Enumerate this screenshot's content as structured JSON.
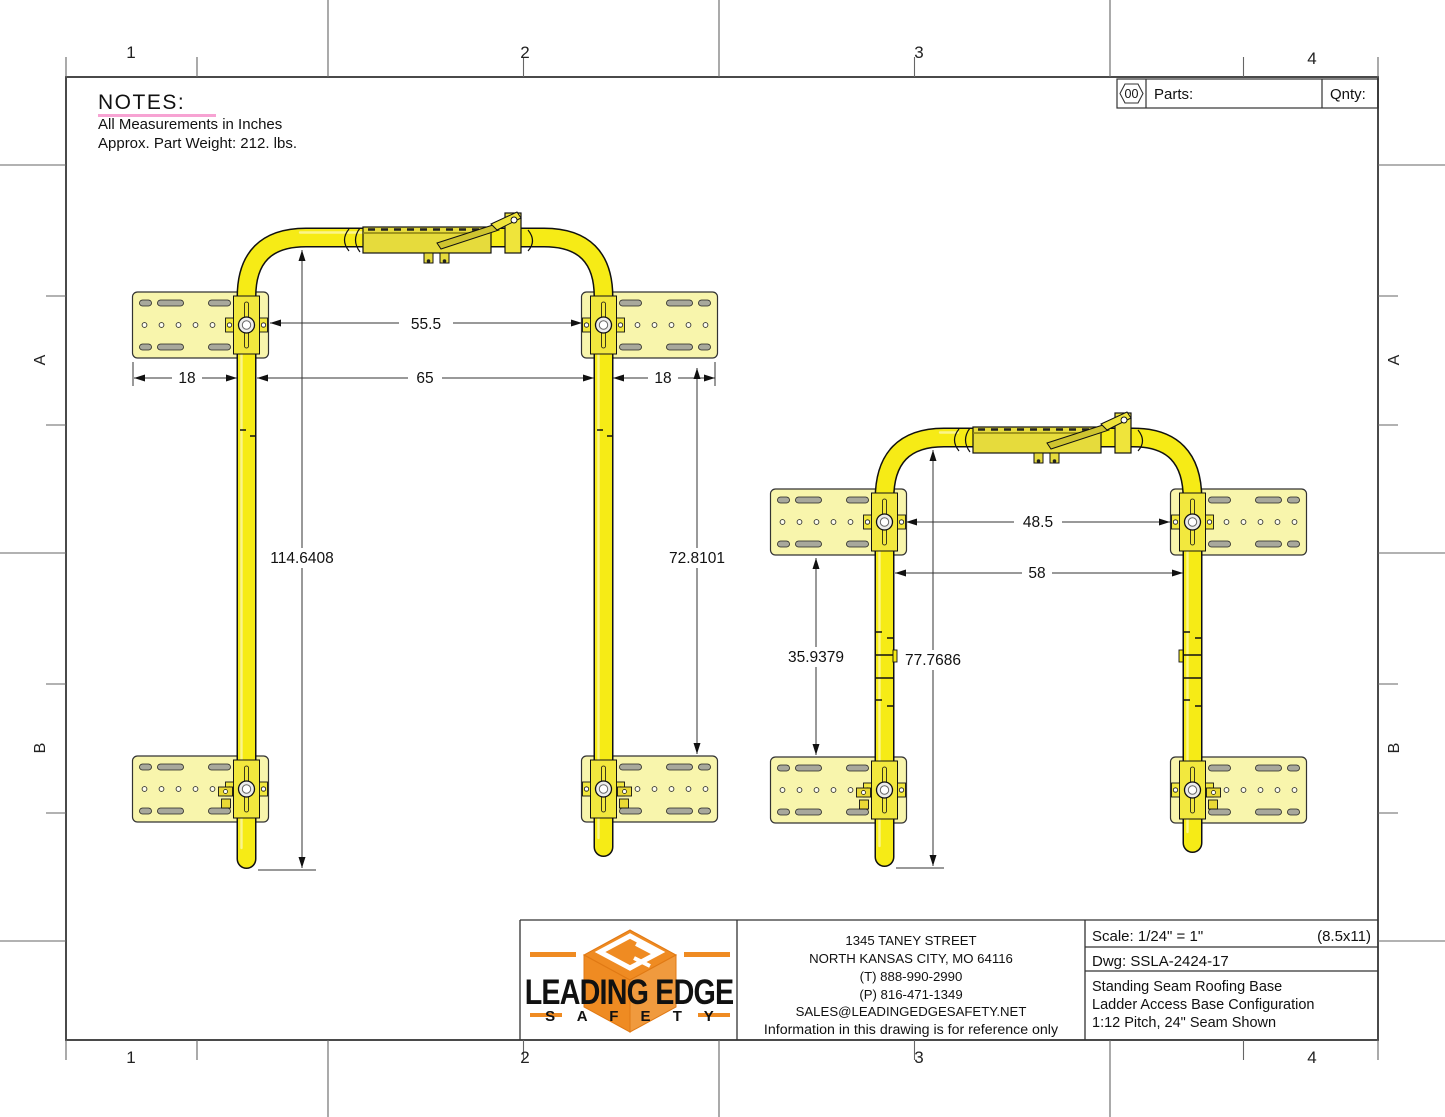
{
  "sheet": {
    "zone_columns": [
      "1",
      "2",
      "3",
      "4"
    ],
    "zone_rows": [
      "A",
      "B"
    ]
  },
  "notes": {
    "title": "NOTES:",
    "lines": [
      "All Measurements in Inches",
      "Approx. Part Weight: 212. lbs."
    ]
  },
  "parts_header": {
    "badge": "00",
    "parts_label": "Parts:",
    "qnty_label": "Qnty:"
  },
  "left_view": {
    "dim_width_between_plates": "55.5",
    "dim_left_plate_width": "18",
    "dim_inner_width": "65",
    "dim_right_plate_width": "18",
    "dim_total_height": "114.6408",
    "dim_right_height": "72.8101"
  },
  "right_view": {
    "dim_width_between_plates": "48.5",
    "dim_inner_width": "58",
    "dim_left_height": "35.9379",
    "dim_total_height": "77.7686"
  },
  "title_block": {
    "logo": {
      "line1": "LEADING EDGE",
      "line2": "S A F E T Y"
    },
    "address": [
      "1345 TANEY STREET",
      "NORTH KANSAS CITY, MO 64116",
      "(T) 888-990-2990",
      "(P) 816-471-1349",
      "SALES@LEADINGEDGESAFETY.NET",
      "Information in this drawing is for reference only"
    ],
    "scale_label": "Scale: 1/24\" = 1\"",
    "sheet_size": "(8.5x11)",
    "dwg_label": "Dwg: SSLA-2424-17",
    "description": [
      "Standing Seam Roofing Base",
      "Ladder Access Base Configuration",
      "1:12 Pitch, 24\" Seam Shown"
    ]
  },
  "colors": {
    "tube_yellow": "#f6eb16",
    "plate_yellow": "#f8f5ac",
    "clamp_olive": "#e6db3c",
    "logo_orange": "#ef8b22",
    "notes_underline_pink": "#f7a3d3",
    "border_gray": "#4a4a4a"
  }
}
